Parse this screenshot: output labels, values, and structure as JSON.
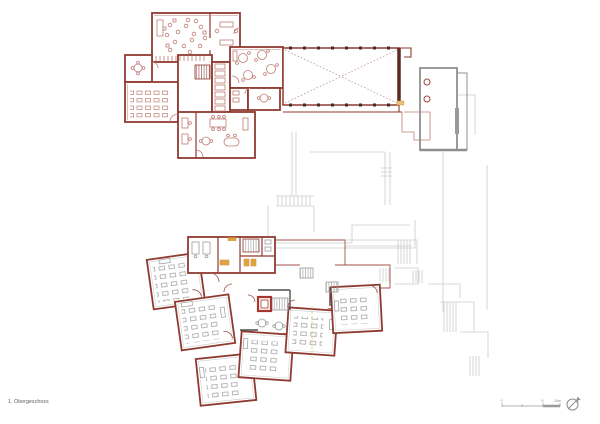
{
  "document": {
    "floor_label": "1. Obergeschoss"
  },
  "scale_bar": {
    "labels": [
      "0",
      "5",
      "10m"
    ]
  },
  "icons": {
    "north_arrow": "compass-north-arrow"
  },
  "colors": {
    "wall_red": "#8f3a31",
    "wall_dark_brown": "#5a2a23",
    "column_dark": "#402e2a",
    "furniture_red": "#bf7d76",
    "furniture_gray": "#9b9b9b",
    "wall_dark_gray": "#4f4f4f",
    "ghost_gray": "#cccccc",
    "annex_gray": "#8f8f8f",
    "elevator_red": "#a8352b",
    "accent_orange": "#e0a33f",
    "accent_yellow": "#e6c96a",
    "drafting_gray": "#9a9a9a",
    "background": "#ffffff"
  }
}
